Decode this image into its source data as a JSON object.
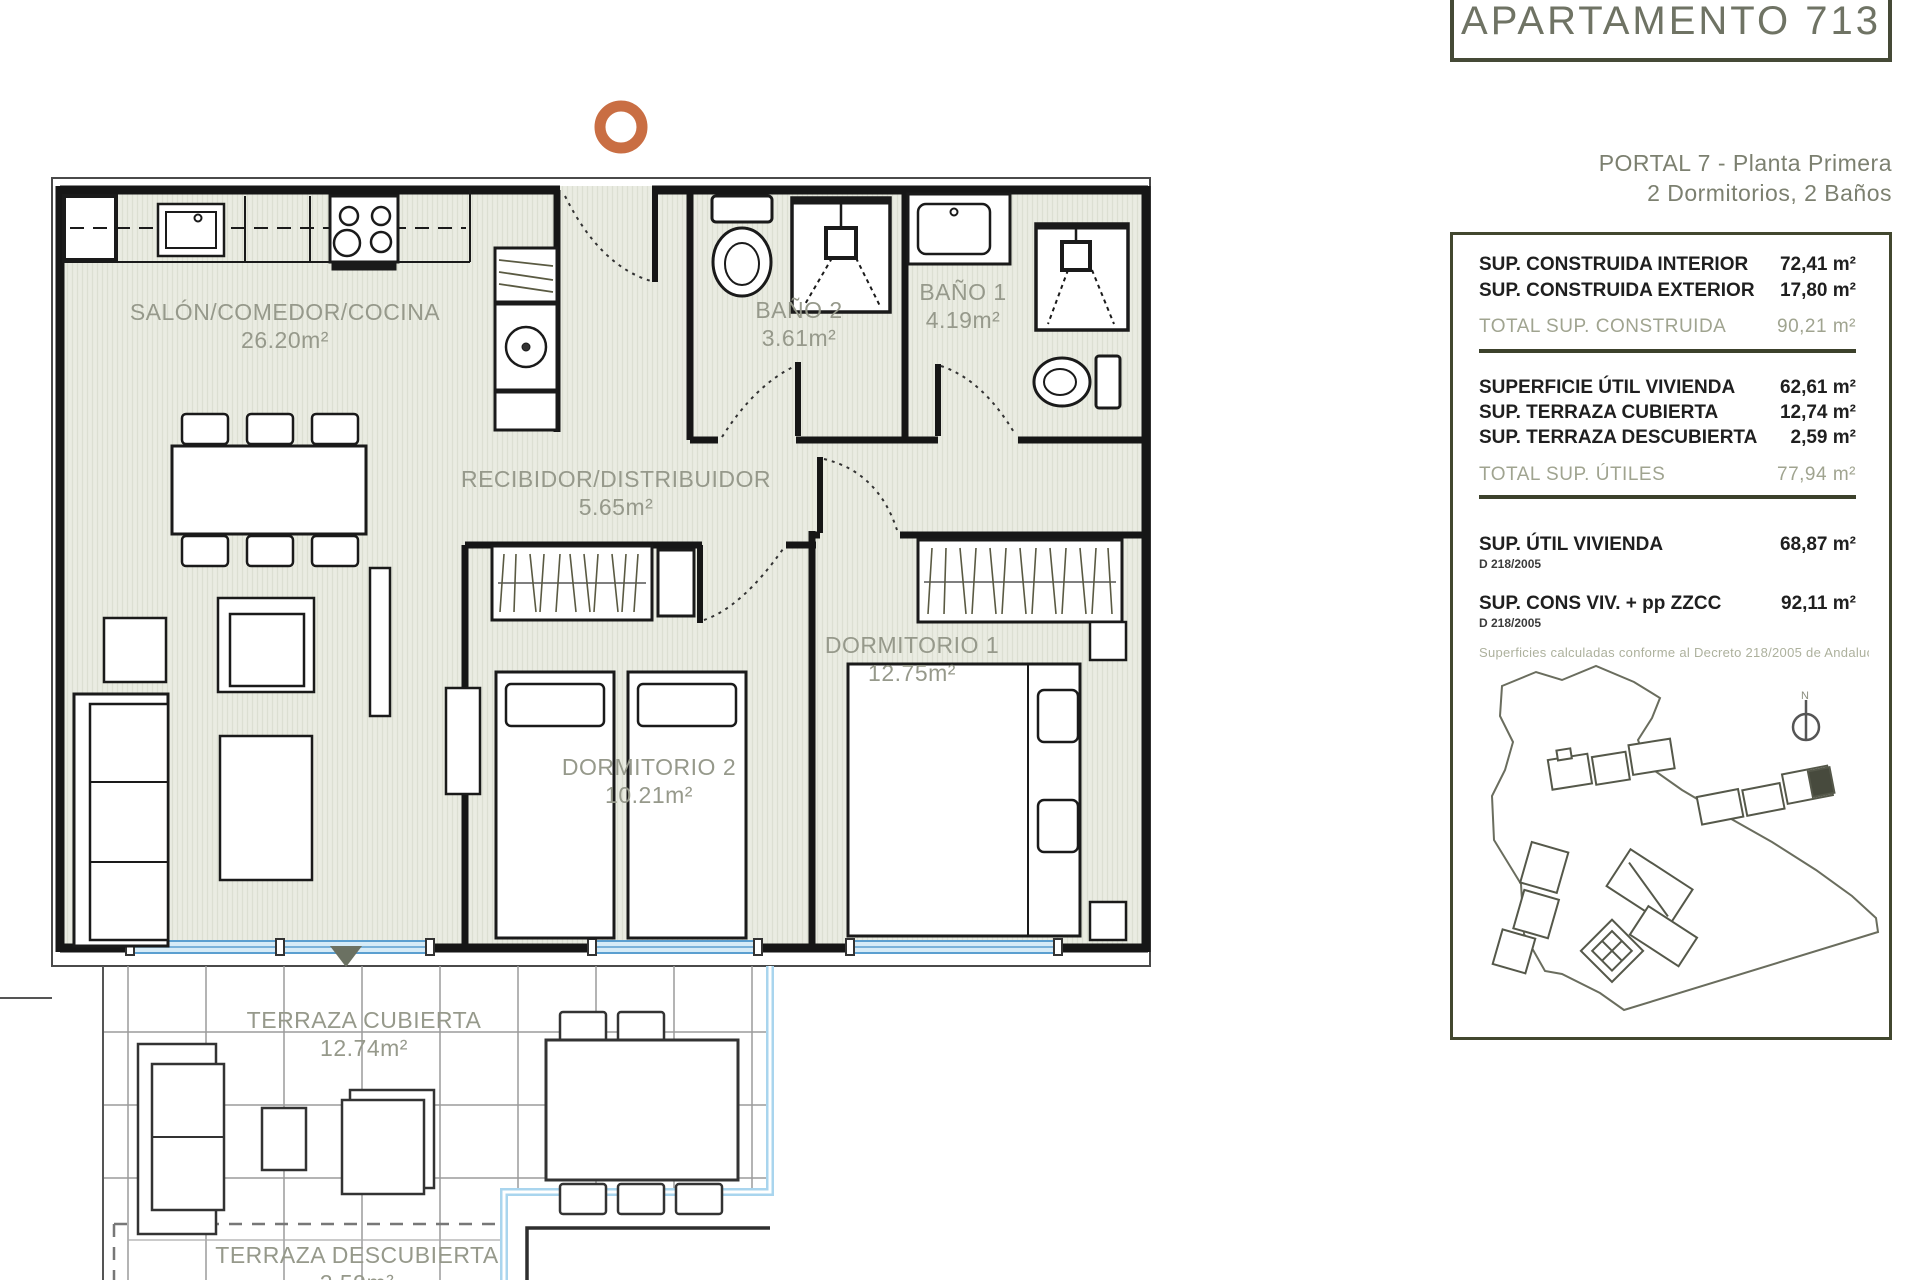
{
  "header": {
    "apartment_title": "APARTAMENTO 713",
    "portal_line": "PORTAL 7 - Planta Primera",
    "config_line": "2 Dormitorios, 2 Baños"
  },
  "panel": {
    "construida": {
      "rows": [
        {
          "label": "SUP. CONSTRUIDA INTERIOR",
          "value": "72,41 m²"
        },
        {
          "label": "SUP. CONSTRUIDA EXTERIOR",
          "value": "17,80 m²"
        }
      ],
      "total": {
        "label": "TOTAL SUP. CONSTRUIDA",
        "value": "90,21 m²"
      }
    },
    "utiles": {
      "rows": [
        {
          "label": "SUPERFICIE ÚTIL VIVIENDA",
          "value": "62,61 m²"
        },
        {
          "label": "SUP. TERRAZA CUBIERTA",
          "value": "12,74 m²"
        },
        {
          "label": "SUP. TERRAZA DESCUBIERTA",
          "value": "2,59 m²"
        }
      ],
      "total": {
        "label": "TOTAL SUP. ÚTILES",
        "value": "77,94 m²"
      }
    },
    "decreto": {
      "rows": [
        {
          "label": "SUP. ÚTIL VIVIENDA",
          "sub": "D 218/2005",
          "value": "68,87 m²"
        },
        {
          "label": "SUP. CONS VIV. + pp ZZCC",
          "sub": "D 218/2005",
          "value": "92,11 m²"
        }
      ],
      "note": "Superficies calculadas conforme al Decreto 218/2005 de Andalucía"
    },
    "north_label": "N"
  },
  "plan": {
    "rooms": [
      {
        "name": "SALÓN/COMEDOR/COCINA",
        "area": "26.20m²"
      },
      {
        "name": "RECIBIDOR/DISTRIBUIDOR",
        "area": "5.65m²"
      },
      {
        "name": "BAÑO 2",
        "area": "3.61m²"
      },
      {
        "name": "BAÑO 1",
        "area": "4.19m²"
      },
      {
        "name": "DORMITORIO 1",
        "area": "12.75m²"
      },
      {
        "name": "DORMITORIO 2",
        "area": "10.21m²"
      },
      {
        "name": "TERRAZA CUBIERTA",
        "area": "12.74m²"
      },
      {
        "name": "TERRAZA DESCUBIERTA",
        "area": "2.59m²"
      }
    ]
  },
  "colors": {
    "accent_orange": "#c96e43",
    "olive_border": "#42472f",
    "glazing_blue": "#7fc0e4",
    "marker_olive": "#6b7162"
  }
}
